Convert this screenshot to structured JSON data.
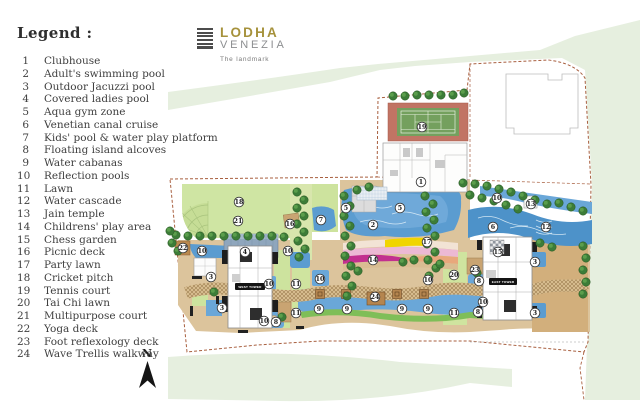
{
  "logo": {
    "title": "LODHA",
    "subtitle": "VENEZIA",
    "tagline": "The landmark"
  },
  "legend": {
    "title": "Legend :",
    "items": [
      {
        "num": "1",
        "label": "Clubhouse"
      },
      {
        "num": "2",
        "label": "Adult's swimming pool"
      },
      {
        "num": "3",
        "label": "Outdoor Jacuzzi pool"
      },
      {
        "num": "4",
        "label": "Covered ladies pool"
      },
      {
        "num": "5",
        "label": "Aqua gym zone"
      },
      {
        "num": "6",
        "label": "Venetian canal cruise"
      },
      {
        "num": "7",
        "label": "Kids' pool & water play platform"
      },
      {
        "num": "8",
        "label": "Floating island alcoves"
      },
      {
        "num": "9",
        "label": "Water cabanas"
      },
      {
        "num": "10",
        "label": "Reflection pools"
      },
      {
        "num": "11",
        "label": "Lawn"
      },
      {
        "num": "12",
        "label": "Water cascade"
      },
      {
        "num": "13",
        "label": "Jain temple"
      },
      {
        "num": "14",
        "label": "Childrens' play area"
      },
      {
        "num": "15",
        "label": "Chess garden"
      },
      {
        "num": "16",
        "label": "Picnic deck"
      },
      {
        "num": "17",
        "label": "Party lawn"
      },
      {
        "num": "18",
        "label": "Cricket pitch"
      },
      {
        "num": "19",
        "label": "Tennis court"
      },
      {
        "num": "20",
        "label": "Tai Chi lawn"
      },
      {
        "num": "21",
        "label": "Multipurpose court"
      },
      {
        "num": "22",
        "label": "Yoga deck"
      },
      {
        "num": "23",
        "label": "Foot reflexology deck"
      },
      {
        "num": "24",
        "label": "Wave Trellis walkway"
      }
    ]
  },
  "compass": {
    "label": "N"
  },
  "plan": {
    "towers": {
      "west": "WEST TOWER",
      "east": "EAST TOWER"
    },
    "markers": [
      {
        "n": "19",
        "x": 422,
        "y": 127
      },
      {
        "n": "1",
        "x": 421,
        "y": 182
      },
      {
        "n": "18",
        "x": 239,
        "y": 202
      },
      {
        "n": "21",
        "x": 238,
        "y": 221
      },
      {
        "n": "16",
        "x": 290,
        "y": 224
      },
      {
        "n": "7",
        "x": 321,
        "y": 220
      },
      {
        "n": "5",
        "x": 346,
        "y": 208
      },
      {
        "n": "5",
        "x": 400,
        "y": 208
      },
      {
        "n": "2",
        "x": 373,
        "y": 225
      },
      {
        "n": "22",
        "x": 183,
        "y": 248
      },
      {
        "n": "10",
        "x": 202,
        "y": 251
      },
      {
        "n": "4",
        "x": 245,
        "y": 252
      },
      {
        "n": "10",
        "x": 288,
        "y": 251
      },
      {
        "n": "3",
        "x": 211,
        "y": 277
      },
      {
        "n": "10",
        "x": 269,
        "y": 284
      },
      {
        "n": "11",
        "x": 296,
        "y": 284
      },
      {
        "n": "10",
        "x": 320,
        "y": 279
      },
      {
        "n": "14",
        "x": 373,
        "y": 260
      },
      {
        "n": "17",
        "x": 427,
        "y": 242
      },
      {
        "n": "3",
        "x": 222,
        "y": 308
      },
      {
        "n": "10",
        "x": 264,
        "y": 321
      },
      {
        "n": "8",
        "x": 276,
        "y": 322
      },
      {
        "n": "11",
        "x": 296,
        "y": 313
      },
      {
        "n": "24",
        "x": 375,
        "y": 297
      },
      {
        "n": "9",
        "x": 319,
        "y": 309
      },
      {
        "n": "9",
        "x": 347,
        "y": 309
      },
      {
        "n": "9",
        "x": 402,
        "y": 309
      },
      {
        "n": "9",
        "x": 428,
        "y": 309
      },
      {
        "n": "11",
        "x": 454,
        "y": 313
      },
      {
        "n": "10",
        "x": 428,
        "y": 280
      },
      {
        "n": "20",
        "x": 454,
        "y": 275
      },
      {
        "n": "23",
        "x": 475,
        "y": 270
      },
      {
        "n": "8",
        "x": 479,
        "y": 281
      },
      {
        "n": "10",
        "x": 483,
        "y": 302
      },
      {
        "n": "8",
        "x": 478,
        "y": 312
      },
      {
        "n": "10",
        "x": 497,
        "y": 198
      },
      {
        "n": "13",
        "x": 531,
        "y": 204
      },
      {
        "n": "6",
        "x": 493,
        "y": 227
      },
      {
        "n": "12",
        "x": 546,
        "y": 227
      },
      {
        "n": "15",
        "x": 498,
        "y": 252
      },
      {
        "n": "3",
        "x": 535,
        "y": 262
      },
      {
        "n": "3",
        "x": 535,
        "y": 313
      }
    ],
    "colors": {
      "boundary": "#a85f3f",
      "site_green": "#e6efdf",
      "lawn": "#cfe5a3",
      "softscape": "#cde39e",
      "water": "#5b9cd0",
      "canal": "#4d92c9",
      "sand": "#dcc49c",
      "deck_brown": "#b5854f",
      "tree": "#3c7c38",
      "court_red": "#c17464",
      "court_green": "#74a05e",
      "play_magenta": "#c2308f",
      "play_yellow": "#f0d500",
      "logo_gold": "#a6923c"
    }
  }
}
